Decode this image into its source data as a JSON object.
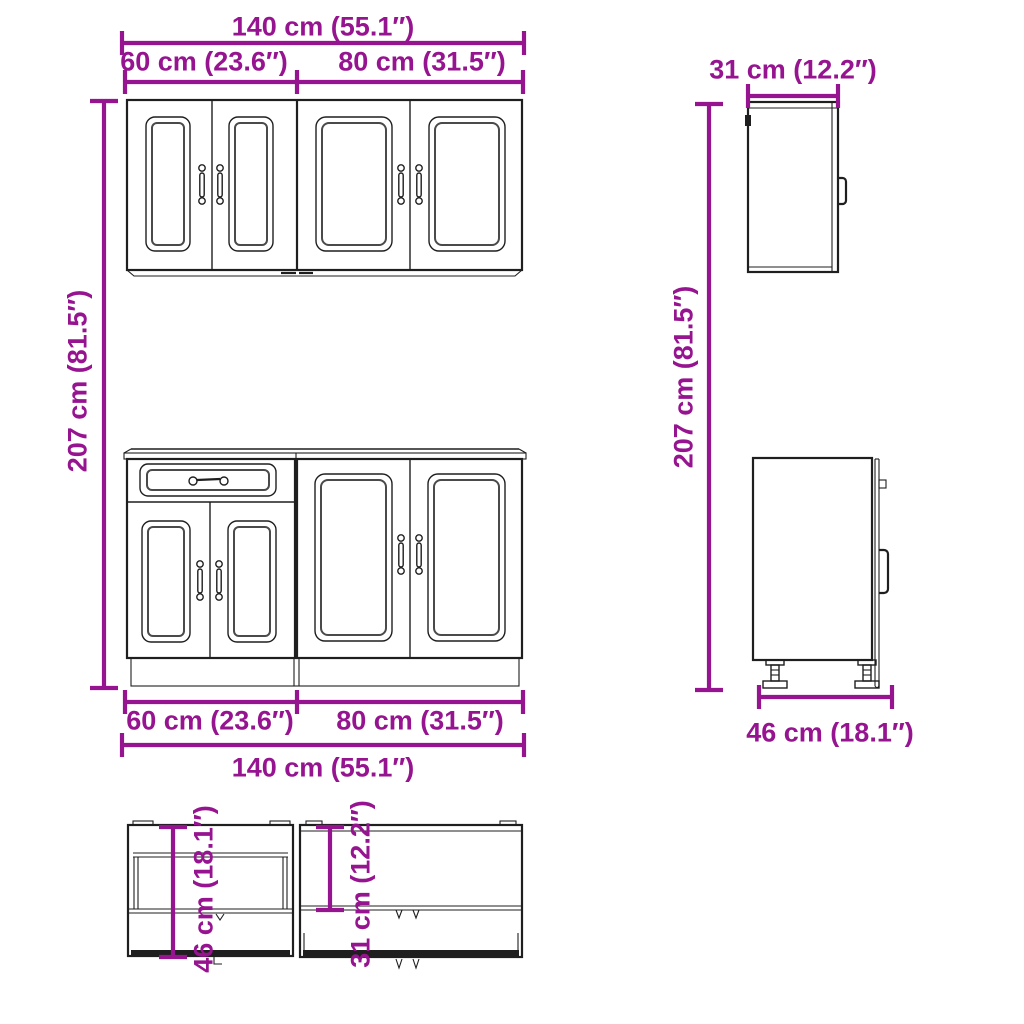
{
  "colors": {
    "dimension": "#961490",
    "outline": "#1f1f1f",
    "background": "#ffffff"
  },
  "dimensions": {
    "wall_front_top": {
      "total_width": "140 cm (55.1″)",
      "left_width": "60 cm (23.6″)",
      "right_width": "80 cm (31.5″)"
    },
    "total_height_left": "207 cm (81.5″)",
    "total_height_right": "207 cm (81.5″)",
    "wall_cabinet_side_depth": "31 cm (12.2″)",
    "base_front_bottom": {
      "left_width": "60 cm (23.6″)",
      "right_width": "80 cm (31.5″)",
      "total_width": "140 cm (55.1″)"
    },
    "base_cabinet_side_depth": "46 cm (18.1″)",
    "top_view_base_depth": "46 cm (18.1″)",
    "top_view_wall_depth": "31 cm (12.2″)"
  }
}
